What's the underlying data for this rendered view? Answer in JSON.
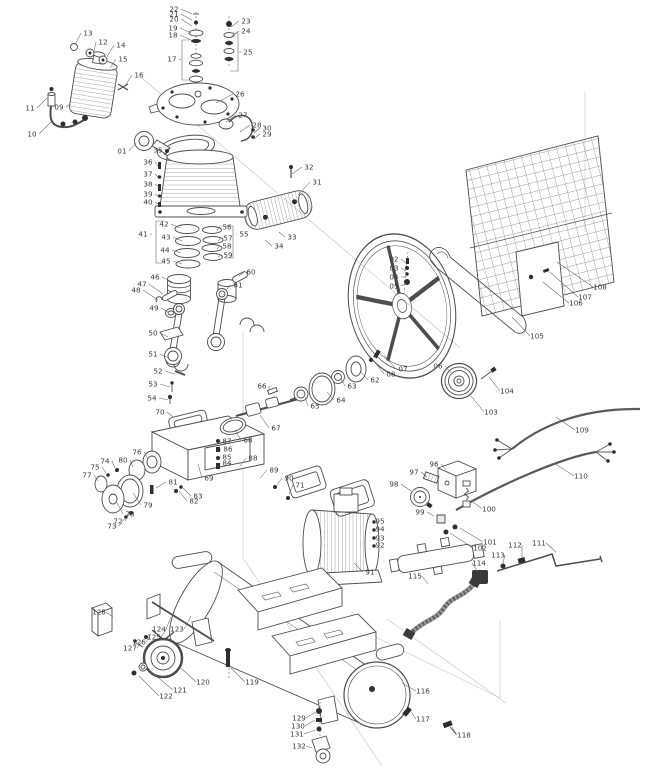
{
  "diagram": {
    "type": "exploded-parts-diagram",
    "subject": "belt-driven air compressor assembly",
    "colors": {
      "background": "#ffffff",
      "line": "#4d4d4d",
      "dark": "#2e2e2e",
      "label": "#3a3a3a",
      "leader": "#6a6a6a",
      "construction": "#c4c4c4",
      "grid": "#7a7a7a"
    },
    "part_labels": [
      {
        "n": "01",
        "x": 122,
        "y": 151,
        "tx": 136,
        "ty": 143
      },
      {
        "n": "02",
        "x": 394,
        "y": 259,
        "tx": 406,
        "ty": 263
      },
      {
        "n": "03",
        "x": 394,
        "y": 268,
        "tx": 406,
        "ty": 271
      },
      {
        "n": "04",
        "x": 394,
        "y": 277,
        "tx": 406,
        "ty": 277
      },
      {
        "n": "05",
        "x": 394,
        "y": 286,
        "tx": 406,
        "ty": 283
      },
      {
        "n": "06",
        "x": 438,
        "y": 366,
        "tx": 451,
        "ty": 373
      },
      {
        "n": "07",
        "x": 403,
        "y": 369,
        "tx": 384,
        "ty": 355
      },
      {
        "n": "08",
        "x": 391,
        "y": 374,
        "tx": 374,
        "ty": 361
      },
      {
        "n": "09",
        "x": 59,
        "y": 107,
        "tx": 70,
        "ty": 104
      },
      {
        "n": "10",
        "x": 32,
        "y": 134,
        "tx": 52,
        "ty": 121
      },
      {
        "n": "11",
        "x": 30,
        "y": 108,
        "tx": 47,
        "ty": 98
      },
      {
        "n": "12",
        "x": 103,
        "y": 42,
        "tx": 94,
        "ty": 51
      },
      {
        "n": "13",
        "x": 88,
        "y": 33,
        "tx": 75,
        "ty": 45
      },
      {
        "n": "14",
        "x": 121,
        "y": 45,
        "tx": 107,
        "ty": 57
      },
      {
        "n": "15",
        "x": 123,
        "y": 59,
        "tx": 110,
        "ty": 68
      },
      {
        "n": "16",
        "x": 139,
        "y": 75,
        "tx": 125,
        "ty": 86
      },
      {
        "n": "17",
        "x": 172,
        "y": 59,
        "tx": 181,
        "ty": 60
      },
      {
        "n": "18",
        "x": 173,
        "y": 35,
        "tx": 191,
        "ty": 40
      },
      {
        "n": "19",
        "x": 173,
        "y": 28,
        "tx": 191,
        "ty": 33
      },
      {
        "n": "20",
        "x": 174,
        "y": 19,
        "tx": 192,
        "ty": 26
      },
      {
        "n": "21",
        "x": 174,
        "y": 14,
        "tx": 192,
        "ty": 20
      },
      {
        "n": "22",
        "x": 174,
        "y": 9,
        "tx": 192,
        "ty": 14
      },
      {
        "n": "23",
        "x": 246,
        "y": 21,
        "tx": 231,
        "ty": 27
      },
      {
        "n": "24",
        "x": 246,
        "y": 31,
        "tx": 231,
        "ty": 37
      },
      {
        "n": "25",
        "x": 248,
        "y": 52,
        "tx": 239,
        "ty": 52
      },
      {
        "n": "26",
        "x": 240,
        "y": 94,
        "tx": 216,
        "ty": 103
      },
      {
        "n": "27",
        "x": 243,
        "y": 115,
        "tx": 226,
        "ty": 122
      },
      {
        "n": "28",
        "x": 257,
        "y": 125,
        "tx": 240,
        "ty": 132
      },
      {
        "n": "29",
        "x": 267,
        "y": 134,
        "tx": 254,
        "ty": 139
      },
      {
        "n": "30",
        "x": 267,
        "y": 128,
        "tx": 254,
        "ty": 133
      },
      {
        "n": "31",
        "x": 317,
        "y": 182,
        "tx": 298,
        "ty": 195
      },
      {
        "n": "32",
        "x": 309,
        "y": 167,
        "tx": 292,
        "ty": 174
      },
      {
        "n": "33",
        "x": 292,
        "y": 237,
        "tx": 279,
        "ty": 232
      },
      {
        "n": "34",
        "x": 279,
        "y": 246,
        "tx": 265,
        "ty": 240
      },
      {
        "n": "35",
        "x": 158,
        "y": 150,
        "tx": 170,
        "ty": 148
      },
      {
        "n": "36",
        "x": 148,
        "y": 162,
        "tx": 158,
        "ty": 166
      },
      {
        "n": "37",
        "x": 148,
        "y": 174,
        "tx": 158,
        "ty": 177
      },
      {
        "n": "38",
        "x": 148,
        "y": 184,
        "tx": 159,
        "ty": 187
      },
      {
        "n": "39",
        "x": 148,
        "y": 194,
        "tx": 159,
        "ty": 197
      },
      {
        "n": "40",
        "x": 148,
        "y": 202,
        "tx": 160,
        "ty": 205
      },
      {
        "n": "41",
        "x": 143,
        "y": 234,
        "tx": 152,
        "ty": 234
      },
      {
        "n": "42",
        "x": 164,
        "y": 224,
        "tx": 180,
        "ty": 228
      },
      {
        "n": "43",
        "x": 166,
        "y": 237,
        "tx": 182,
        "ty": 241
      },
      {
        "n": "44",
        "x": 165,
        "y": 250,
        "tx": 181,
        "ty": 253
      },
      {
        "n": "45",
        "x": 166,
        "y": 261,
        "tx": 182,
        "ty": 264
      },
      {
        "n": "46",
        "x": 155,
        "y": 277,
        "tx": 172,
        "ty": 282
      },
      {
        "n": "47",
        "x": 142,
        "y": 284,
        "tx": 163,
        "ty": 294
      },
      {
        "n": "48",
        "x": 136,
        "y": 290,
        "tx": 158,
        "ty": 300
      },
      {
        "n": "49",
        "x": 154,
        "y": 308,
        "tx": 168,
        "ty": 312
      },
      {
        "n": "50",
        "x": 153,
        "y": 333,
        "tx": 168,
        "ty": 337
      },
      {
        "n": "51",
        "x": 153,
        "y": 354,
        "tx": 169,
        "ty": 358
      },
      {
        "n": "52",
        "x": 158,
        "y": 371,
        "tx": 175,
        "ty": 374
      },
      {
        "n": "53",
        "x": 153,
        "y": 384,
        "tx": 170,
        "ty": 387
      },
      {
        "n": "54",
        "x": 152,
        "y": 398,
        "tx": 168,
        "ty": 400
      },
      {
        "n": "55",
        "x": 244,
        "y": 234,
        "tx": 236,
        "ty": 234
      },
      {
        "n": "56",
        "x": 227,
        "y": 227,
        "tx": 217,
        "ty": 230
      },
      {
        "n": "57",
        "x": 228,
        "y": 238,
        "tx": 218,
        "ty": 241
      },
      {
        "n": "58",
        "x": 227,
        "y": 246,
        "tx": 217,
        "ty": 249
      },
      {
        "n": "59",
        "x": 228,
        "y": 255,
        "tx": 218,
        "ty": 257
      },
      {
        "n": "60",
        "x": 251,
        "y": 272,
        "tx": 239,
        "ty": 276
      },
      {
        "n": "61",
        "x": 238,
        "y": 285,
        "tx": 227,
        "ty": 289
      },
      {
        "n": "62",
        "x": 375,
        "y": 380,
        "tx": 360,
        "ty": 371
      },
      {
        "n": "63",
        "x": 352,
        "y": 386,
        "tx": 341,
        "ty": 379
      },
      {
        "n": "64",
        "x": 341,
        "y": 400,
        "tx": 327,
        "ty": 392
      },
      {
        "n": "65",
        "x": 315,
        "y": 406,
        "tx": 305,
        "ty": 397
      },
      {
        "n": "66",
        "x": 262,
        "y": 386,
        "tx": 269,
        "ty": 390
      },
      {
        "n": "67",
        "x": 276,
        "y": 428,
        "tx": 260,
        "ty": 415
      },
      {
        "n": "68",
        "x": 248,
        "y": 440,
        "tx": 235,
        "ty": 430
      },
      {
        "n": "69",
        "x": 209,
        "y": 478,
        "tx": 198,
        "ty": 464
      },
      {
        "n": "70",
        "x": 160,
        "y": 412,
        "tx": 173,
        "ty": 417
      },
      {
        "n": "71",
        "x": 300,
        "y": 485,
        "tx": 289,
        "ty": 494
      },
      {
        "n": "72",
        "x": 118,
        "y": 521,
        "tx": 130,
        "ty": 513
      },
      {
        "n": "73",
        "x": 112,
        "y": 526,
        "tx": 125,
        "ty": 518
      },
      {
        "n": "74",
        "x": 105,
        "y": 461,
        "tx": 115,
        "ty": 468
      },
      {
        "n": "75",
        "x": 95,
        "y": 467,
        "tx": 106,
        "ty": 473
      },
      {
        "n": "76",
        "x": 137,
        "y": 452,
        "tx": 148,
        "ty": 459
      },
      {
        "n": "77",
        "x": 87,
        "y": 475,
        "tx": 98,
        "ty": 481
      },
      {
        "n": "78",
        "x": 130,
        "y": 514,
        "tx": 116,
        "ty": 501
      },
      {
        "n": "79",
        "x": 148,
        "y": 505,
        "tx": 133,
        "ty": 493
      },
      {
        "n": "80",
        "x": 123,
        "y": 460,
        "tx": 133,
        "ty": 467
      },
      {
        "n": "81",
        "x": 173,
        "y": 482,
        "tx": 156,
        "ty": 488
      },
      {
        "n": "82",
        "x": 194,
        "y": 501,
        "tx": 179,
        "ty": 491
      },
      {
        "n": "83",
        "x": 198,
        "y": 496,
        "tx": 183,
        "ty": 488
      },
      {
        "n": "84",
        "x": 227,
        "y": 463,
        "tx": 220,
        "ty": 464
      },
      {
        "n": "85",
        "x": 227,
        "y": 457,
        "tx": 220,
        "ty": 458
      },
      {
        "n": "86",
        "x": 228,
        "y": 449,
        "tx": 220,
        "ty": 450
      },
      {
        "n": "87",
        "x": 227,
        "y": 441,
        "tx": 220,
        "ty": 442
      },
      {
        "n": "88",
        "x": 253,
        "y": 458,
        "tx": 240,
        "ty": 466
      },
      {
        "n": "89",
        "x": 274,
        "y": 470,
        "tx": 260,
        "ty": 478
      },
      {
        "n": "90",
        "x": 289,
        "y": 478,
        "tx": 277,
        "ty": 485
      },
      {
        "n": "91",
        "x": 370,
        "y": 572,
        "tx": 354,
        "ty": 563
      },
      {
        "n": "92",
        "x": 380,
        "y": 545,
        "tx": 372,
        "ty": 546
      },
      {
        "n": "93",
        "x": 380,
        "y": 538,
        "tx": 372,
        "ty": 539
      },
      {
        "n": "94",
        "x": 380,
        "y": 529,
        "tx": 372,
        "ty": 530
      },
      {
        "n": "95",
        "x": 380,
        "y": 521,
        "tx": 372,
        "ty": 522
      },
      {
        "n": "96",
        "x": 434,
        "y": 464,
        "tx": 446,
        "ty": 470
      },
      {
        "n": "97",
        "x": 414,
        "y": 472,
        "tx": 427,
        "ty": 477
      },
      {
        "n": "98",
        "x": 394,
        "y": 484,
        "tx": 411,
        "ty": 491
      },
      {
        "n": "99",
        "x": 420,
        "y": 512,
        "tx": 434,
        "ty": 516
      },
      {
        "n": "100",
        "x": 489,
        "y": 509,
        "tx": 472,
        "ty": 501
      },
      {
        "n": "101",
        "x": 490,
        "y": 542,
        "tx": 460,
        "ty": 528
      },
      {
        "n": "102",
        "x": 480,
        "y": 548,
        "tx": 450,
        "ty": 533
      },
      {
        "n": "103",
        "x": 491,
        "y": 412,
        "tx": 471,
        "ty": 396
      },
      {
        "n": "104",
        "x": 507,
        "y": 391,
        "tx": 489,
        "ty": 377
      },
      {
        "n": "105",
        "x": 537,
        "y": 336,
        "tx": 512,
        "ty": 317
      },
      {
        "n": "106",
        "x": 576,
        "y": 303,
        "tx": 543,
        "ty": 282
      },
      {
        "n": "107",
        "x": 585,
        "y": 297,
        "tx": 550,
        "ty": 272
      },
      {
        "n": "108",
        "x": 600,
        "y": 287,
        "tx": 557,
        "ty": 262
      },
      {
        "n": "109",
        "x": 582,
        "y": 430,
        "tx": 556,
        "ty": 417
      },
      {
        "n": "110",
        "x": 581,
        "y": 476,
        "tx": 554,
        "ty": 463
      },
      {
        "n": "111",
        "x": 539,
        "y": 543,
        "tx": 556,
        "ty": 552
      },
      {
        "n": "112",
        "x": 515,
        "y": 545,
        "tx": 522,
        "ty": 557
      },
      {
        "n": "113",
        "x": 498,
        "y": 555,
        "tx": 503,
        "ty": 563
      },
      {
        "n": "114",
        "x": 479,
        "y": 563,
        "tx": 478,
        "ty": 572
      },
      {
        "n": "115",
        "x": 415,
        "y": 576,
        "tx": 428,
        "ty": 584
      },
      {
        "n": "116",
        "x": 423,
        "y": 691,
        "tx": 402,
        "ty": 683
      },
      {
        "n": "117",
        "x": 423,
        "y": 719,
        "tx": 411,
        "ty": 712
      },
      {
        "n": "118",
        "x": 464,
        "y": 735,
        "tx": 452,
        "ty": 727
      },
      {
        "n": "119",
        "x": 252,
        "y": 682,
        "tx": 231,
        "ty": 668
      },
      {
        "n": "120",
        "x": 203,
        "y": 682,
        "tx": 181,
        "ty": 668
      },
      {
        "n": "121",
        "x": 180,
        "y": 690,
        "tx": 149,
        "ty": 670
      },
      {
        "n": "122",
        "x": 166,
        "y": 696,
        "tx": 139,
        "ty": 676
      },
      {
        "n": "123",
        "x": 177,
        "y": 629,
        "tx": 191,
        "ty": 616
      },
      {
        "n": "124",
        "x": 159,
        "y": 629,
        "tx": 171,
        "ty": 617
      },
      {
        "n": "125",
        "x": 154,
        "y": 637,
        "tx": 167,
        "ty": 628
      },
      {
        "n": "126",
        "x": 139,
        "y": 642,
        "tx": 151,
        "ty": 634
      },
      {
        "n": "127",
        "x": 130,
        "y": 648,
        "tx": 143,
        "ty": 641
      },
      {
        "n": "128",
        "x": 99,
        "y": 612,
        "tx": 113,
        "ty": 617
      },
      {
        "n": "129",
        "x": 299,
        "y": 718,
        "tx": 316,
        "ty": 712
      },
      {
        "n": "130",
        "x": 298,
        "y": 726,
        "tx": 315,
        "ty": 720
      },
      {
        "n": "131",
        "x": 297,
        "y": 734,
        "tx": 316,
        "ty": 730
      },
      {
        "n": "132",
        "x": 299,
        "y": 746,
        "tx": 312,
        "ty": 748
      }
    ],
    "brackets": [
      {
        "part": "17",
        "x": 182,
        "y1": 40,
        "y2": 80,
        "dir": 1
      },
      {
        "part": "25",
        "x": 238,
        "y1": 33,
        "y2": 71,
        "dir": -1
      },
      {
        "part": "41",
        "x": 156,
        "y1": 221,
        "y2": 263,
        "dir": 1
      },
      {
        "part": "55",
        "x": 233,
        "y1": 226,
        "y2": 258,
        "dir": -1
      }
    ]
  }
}
